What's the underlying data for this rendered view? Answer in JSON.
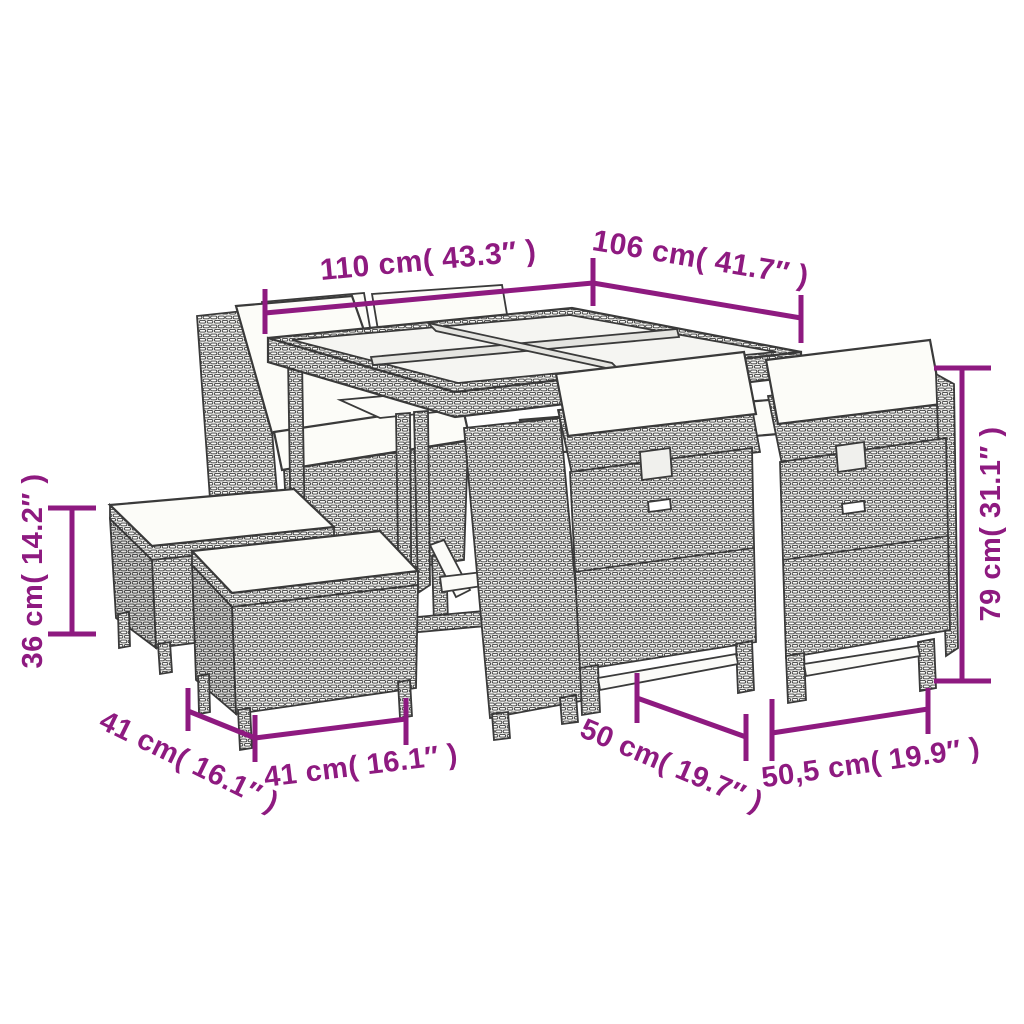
{
  "figure": {
    "kind": "product-dimension-line-drawing",
    "subject": "poly rattan garden dining set: glass-top table, cube chairs with white cushions, stacking stools with white cushions",
    "background_color": "#ffffff",
    "line_color": "#3a3a3a",
    "accent_color": "#8E1A80"
  },
  "dims": {
    "table_width": {
      "value": "110 cm( 43.3″ )"
    },
    "table_depth": {
      "value": "106 cm( 41.7″ )"
    },
    "chair_height": {
      "value": "79 cm( 31.1″ )"
    },
    "stool_height": {
      "value": "36 cm( 14.2″ )"
    },
    "stool_depth": {
      "value": "41 cm( 16.1″ )"
    },
    "stool_width": {
      "value": "41 cm( 16.1″ )"
    },
    "chair_depth": {
      "value": "50 cm( 19.7″ )"
    },
    "chair_width": {
      "value": "50,5 cm( 19.9″ )"
    }
  },
  "parts": [
    "dining-table-glass-top",
    "back-chair-backrests",
    "left-tucked-chair",
    "front-chair-left",
    "front-chair-right",
    "stool-back",
    "stool-front"
  ]
}
